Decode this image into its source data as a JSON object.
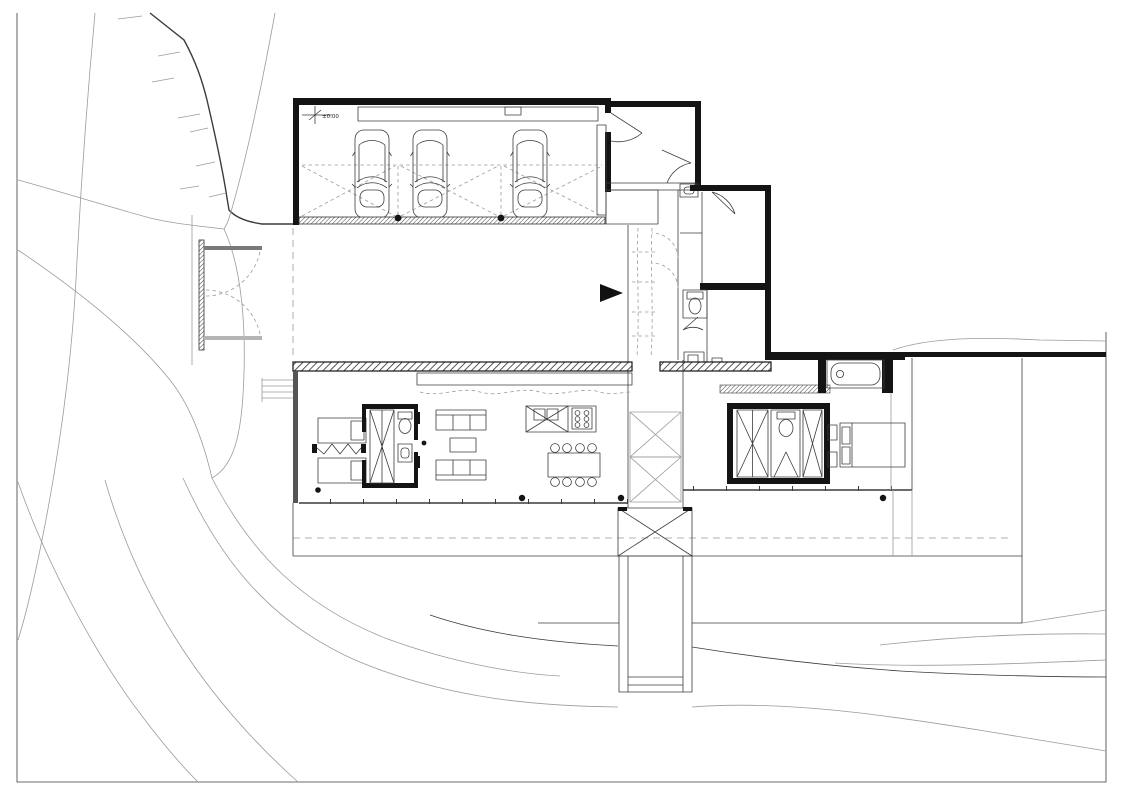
{
  "drawing": {
    "kind": "architectural floor plan, ground level with site contours",
    "level_marker_label": "±0.00",
    "colors": {
      "background": "#ffffff",
      "line": "#3c3c3c",
      "wall": "#141414",
      "light": "#9b9b9b"
    },
    "inventory": {
      "cars": 3,
      "garage_bays": 3,
      "sofas": 2,
      "dining_seats": 8,
      "single_beds": 2,
      "double_beds": 1,
      "bathtubs": 1,
      "toilets": 3,
      "stairs": 1,
      "piers": 1
    }
  }
}
